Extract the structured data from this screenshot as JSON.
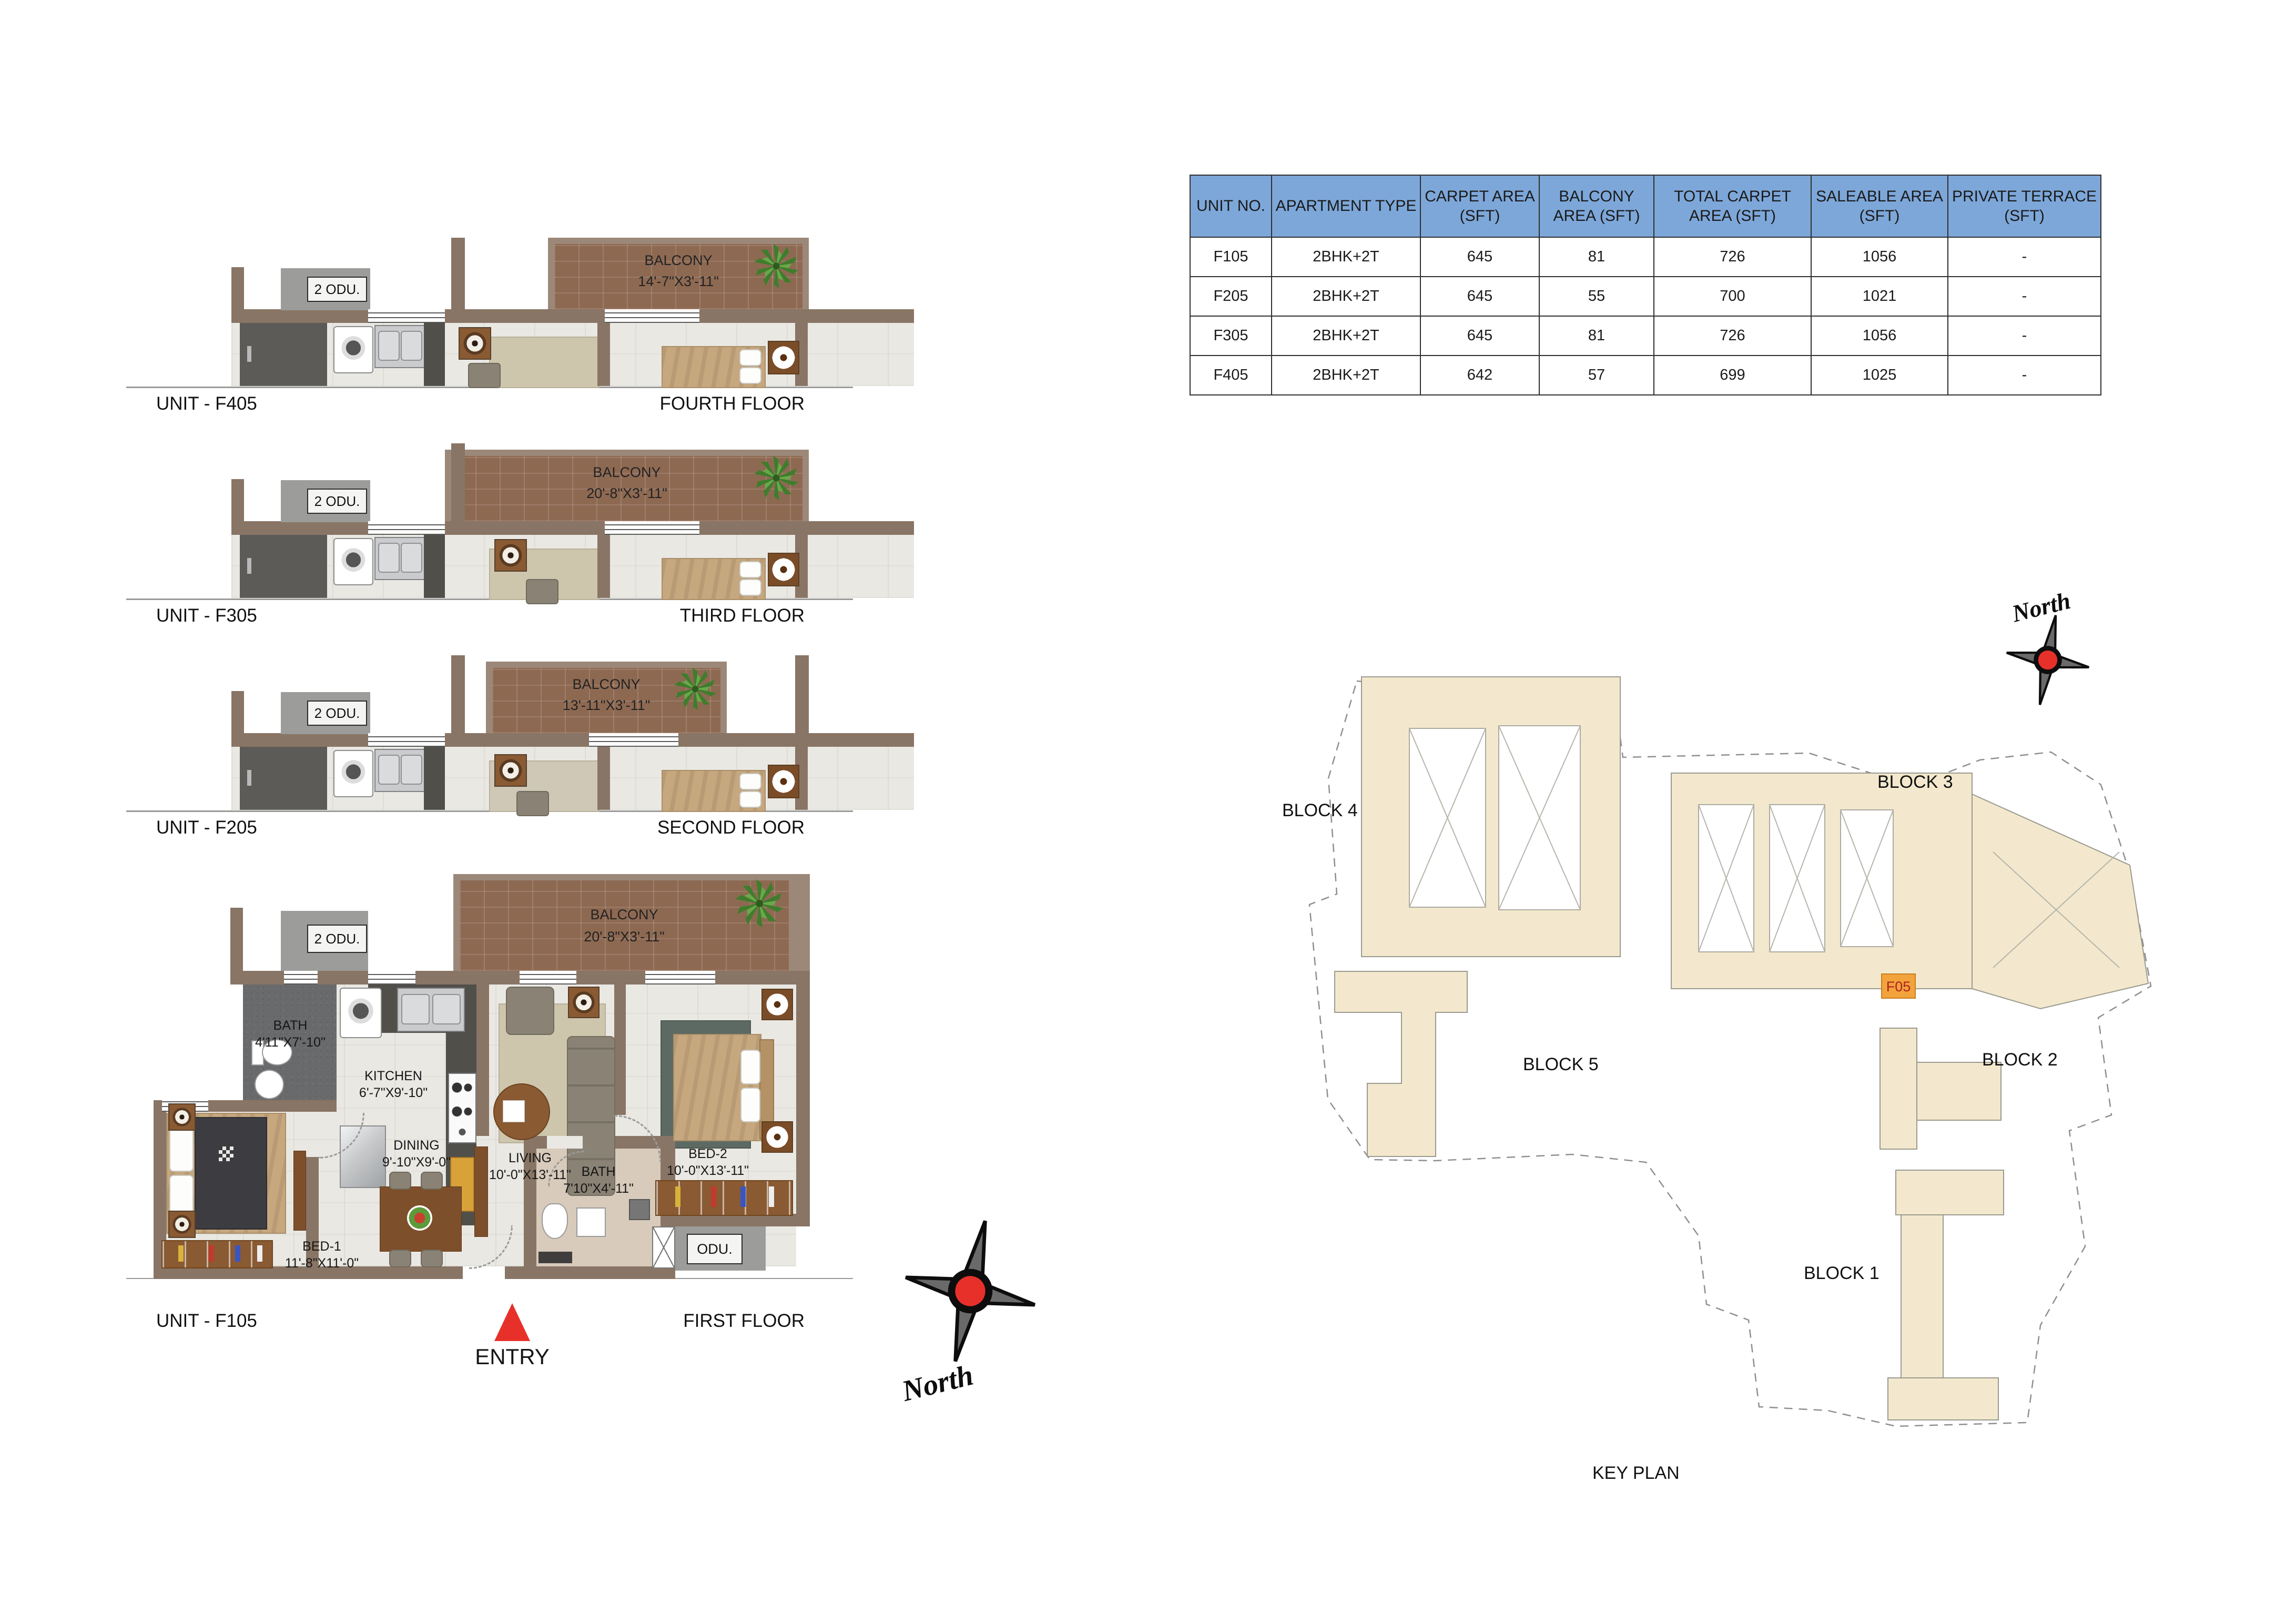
{
  "table": {
    "headers": [
      "UNIT NO.",
      "APARTMENT TYPE",
      "CARPET AREA (SFT)",
      "BALCONY AREA (SFT)",
      "TOTAL CARPET AREA (SFT)",
      "SALEABLE AREA (SFT)",
      "PRIVATE TERRACE (SFT)"
    ],
    "rows": [
      [
        "F105",
        "2BHK+2T",
        "645",
        "81",
        "726",
        "1056",
        "-"
      ],
      [
        "F205",
        "2BHK+2T",
        "645",
        "55",
        "700",
        "1021",
        "-"
      ],
      [
        "F305",
        "2BHK+2T",
        "645",
        "81",
        "726",
        "1056",
        "-"
      ],
      [
        "F405",
        "2BHK+2T",
        "642",
        "57",
        "699",
        "1025",
        "-"
      ]
    ]
  },
  "floors": [
    {
      "unit": "UNIT - F405",
      "floor": "FOURTH FLOOR",
      "balcony_name": "BALCONY",
      "balcony_dims": "14'-7\"X3'-11\"",
      "odu_label": "2 ODU."
    },
    {
      "unit": "UNIT - F305",
      "floor": "THIRD FLOOR",
      "balcony_name": "BALCONY",
      "balcony_dims": "20'-8\"X3'-11\"",
      "odu_label": "2 ODU."
    },
    {
      "unit": "UNIT - F205",
      "floor": "SECOND FLOOR",
      "balcony_name": "BALCONY",
      "balcony_dims": "13'-11\"X3'-11\"",
      "odu_label": "2 ODU."
    },
    {
      "unit": "UNIT - F105",
      "floor": "FIRST FLOOR",
      "balcony_name": "BALCONY",
      "balcony_dims": "20'-8\"X3'-11\"",
      "odu_label": "2 ODU."
    }
  ],
  "first_floor": {
    "bath1_name": "BATH",
    "bath1_dims": "4'11\"X7'-10\"",
    "kitchen_name": "KITCHEN",
    "kitchen_dims": "6'-7\"X9'-10\"",
    "dining_name": "DINING",
    "dining_dims": "9'-10\"X9'-0\"",
    "living_name": "LIVING",
    "living_dims": "10'-0\"X13'-11\"",
    "bed1_name": "BED-1",
    "bed1_dims": "11'-8\"X11'-0\"",
    "bed2_name": "BED-2",
    "bed2_dims": "10'-0\"X13'-11\"",
    "bath2_name": "BATH",
    "bath2_dims": "7'10\"X4'-11\"",
    "odu_small_label": "ODU.",
    "entry_label": "ENTRY"
  },
  "key_plan": {
    "title": "KEY PLAN",
    "block_labels": {
      "b1": "BLOCK 1",
      "b2": "BLOCK 2",
      "b3": "BLOCK 3",
      "b4": "BLOCK 4",
      "b5": "BLOCK 5"
    },
    "highlight_unit": "F05",
    "north_label": "North"
  },
  "colors": {
    "table_header_bg": "#7da7d9",
    "wall": "#897565",
    "balcony_brick": "#8e6952",
    "highlight_orange": "#f2a33c",
    "compass_red": "#e8302a"
  }
}
